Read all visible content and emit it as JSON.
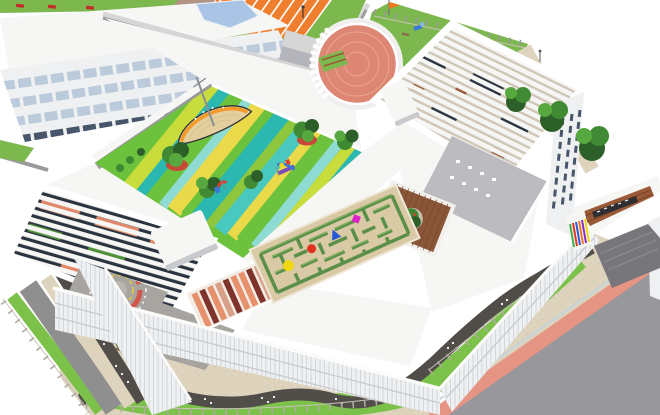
{
  "meta": {
    "title": "Aerial 3D architectural rendering of a kindergarten campus with rooftop playground, hedge maze and surrounding streets",
    "image_type": "architectural-rendering",
    "view": "aerial isometric bird's-eye",
    "canvas": {
      "width": 660,
      "height": 415
    },
    "visible_text": "none"
  },
  "scene": {
    "neighboring_campus": {
      "label": "adjacent school campus (top-left)",
      "features": [
        "white classroom building with ribbon windows",
        "blue glass skylight",
        "gray stair tower",
        "orange running track with white lane lines",
        "parterre garden of concentric square paths",
        "lawns with tan footpaths",
        "street strip with parked red cars",
        "gray boundary wall"
      ]
    },
    "kindergarten": {
      "label": "kindergarten complex (center)",
      "north_lawn": {
        "label": "fenced north lawn with orange flag and toddler slide"
      },
      "roof_play_area": {
        "label": "striped rooftop play area",
        "stripe_colors": [
          "#c8dc3c",
          "#6cc23c",
          "#2ab8b0",
          "#8edbd4",
          "#ead949",
          "#8ec73e",
          "#49c8c0",
          "#2a9aa0"
        ],
        "equipment": [
          "ship-shaped play deck with mast",
          "climbing frame with slides",
          "toddler play unit"
        ],
        "trees_in_planters": 5
      },
      "maze": {
        "label": "hedge maze garden on tan paving",
        "balls": [
          {
            "name": "yellow-ball",
            "color": "#f2d813"
          },
          {
            "name": "red-ball",
            "color": "#e03020"
          },
          {
            "name": "blue-ball",
            "color": "#2858d8"
          },
          {
            "name": "magenta-ball",
            "color": "#e020c8"
          }
        ]
      },
      "round_hall": {
        "label": "cylindrical hall with terracotta tiled roof and white colonnade"
      },
      "east_wing": {
        "label": "east wing with white slatted pergola roof"
      },
      "north_wing": {
        "label": "north wing pergola roof over coral and green canopies"
      },
      "deck_courtyard": {
        "label": "timber deck courtyard with planter tree"
      },
      "salmon_courtyard": {
        "label": "open-air courtyard with coral partitions"
      },
      "traffic_circle": {
        "label": "traffic-training play circle with red and yellow arcs"
      },
      "plaza": {
        "label": "gray paved courtyard plaza with benches"
      },
      "roof_terrace": {
        "label": "roof terrace with white seating"
      },
      "entrance_gate": {
        "label": "entrance gate with louvered canopy and rainbow striped pillar"
      }
    },
    "streetscape": {
      "label": "surrounding streets (bottom and right)",
      "features": [
        "beige paved sidewalk",
        "serpentine dark footpath with white pebble dots",
        "grass verge",
        "perimeter fence posts",
        "salmon cycle lane",
        "wide asphalt road",
        "west service road"
      ]
    }
  },
  "colors": {
    "sky": "#ffffff",
    "campus_grass": "#7db84e",
    "grass": "#7cc24a",
    "hedge": "#2e5e28",
    "road": "#98979b",
    "road_west": "#8f8f90",
    "plaza": "#a8a5a1",
    "plaza_dot": "#9b9894",
    "path_dark": "#514d49",
    "beige": "#ded3bd",
    "beige_dot": "#d2c7ae",
    "pink_lane": "#e69484",
    "curb": "#c3d4dc",
    "wall": "#9a9a9a",
    "wall_light": "#d6d6d6",
    "white_roof": "#f6f6f4",
    "under_roof": "#cfc6b8",
    "facade": "#eef0f1",
    "facade_line": "#d3d6da",
    "facade_shadow": "#c9cacd",
    "window_dark": "#47566a",
    "window_blue": "#bccbdb",
    "atrium": "#a9c4e4",
    "tower": "#b3b5ba",
    "track": "#ef7f2e",
    "path_tan": "#d9c8a2",
    "path_mauve": "#b29384",
    "garden_tan": "#dcc89e",
    "garden_green": "#7cb43e",
    "drum_roof": "#dd8673",
    "drum_line": "#eaa591",
    "boat_deck": "#e3cf9e",
    "boat_rim": "#f49a2a",
    "mast": "#8a8f96",
    "s1": "#c8dc3c",
    "s2": "#6cc23c",
    "s3": "#2ab8b0",
    "s4": "#8edbd4",
    "s5": "#ead949",
    "s6": "#8ec73e",
    "s7": "#49c8c0",
    "s8": "#2a9aa0",
    "tree_dark": "#2d5f28",
    "tree_mid": "#3f8a32",
    "tree_light": "#57a83e",
    "planter": "#c84838",
    "maze_bg": "#d9c9a4",
    "hedge_green": "#5a8f4a",
    "hedge_light": "#86b360",
    "ball_yellow": "#f2d813",
    "ball_red": "#e03020",
    "ball_blue": "#2858d8",
    "ball_magenta": "#e020c8",
    "court_base": "#f2ece4",
    "court_salmon": "#e6906c",
    "court_red": "#7e342c",
    "court_tan": "#d8a088",
    "deck": "#8a5638",
    "deck_line": "#76452a",
    "deck_planter": "#c9bfae",
    "pergola_dark": "#2a3340",
    "pergola_salmon": "#e08868",
    "pergola_green": "#4e8f38",
    "terrace": "#bcbcc0",
    "gate_brown": "#9a5a38",
    "gate_brown_dark": "#7a4228",
    "ramp": "#77777b",
    "ramp_line": "#8d8d91",
    "sign": "#2f2f33",
    "bench": "#8a6a4a",
    "flag": "#f07820",
    "slide_blue": "#3a78d8",
    "slide_light": "#88b8e8",
    "arc_red": "#d2574a",
    "arc_yellow": "#e8c83a",
    "car_red": "#c03028",
    "fence": "#b0aaa0",
    "fence_rail": "#c9c4ba",
    "table_white": "#ffffff"
  }
}
